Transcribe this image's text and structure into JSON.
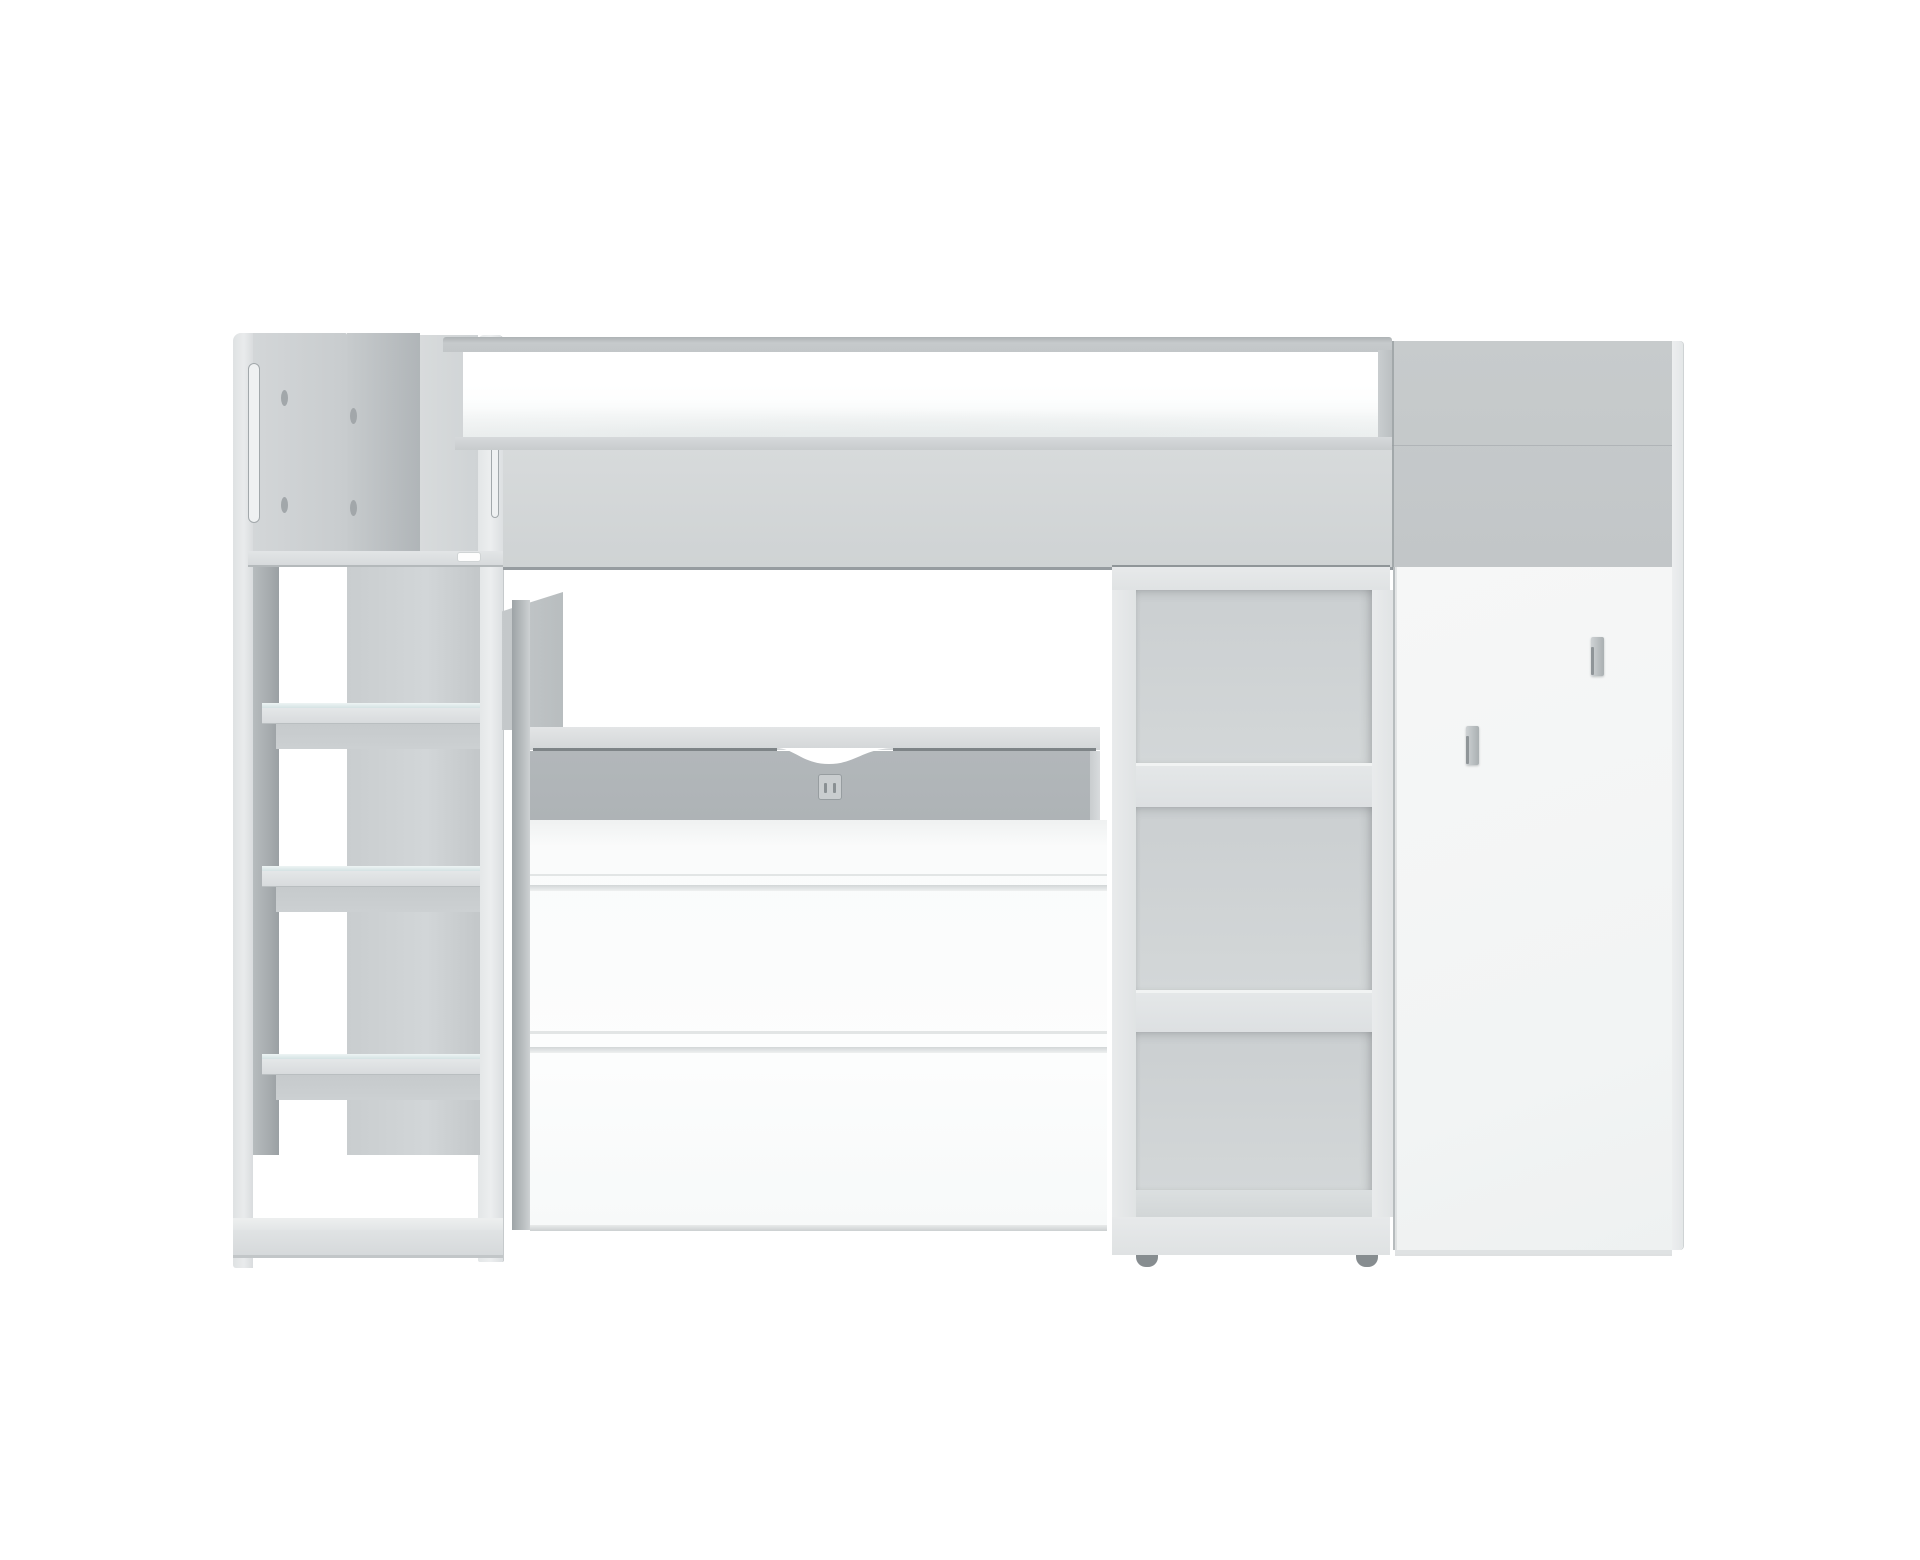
{
  "scene": {
    "type": "product-photo",
    "subject": "kids loft bed combination: high bed with guard rail, stair-ladder with shelves, desk with chest of drawers, open shelving unit and wardrobe",
    "background_color": "#ffffff",
    "text_content": "none"
  },
  "colors": {
    "bg": "#ffffff",
    "panel_light": "#d4d7d8",
    "panel_mid": "#c6cacc",
    "panel_dark": "#aeb3b6",
    "front_white": "#fafbfb",
    "rail_gray": "#b2b7ba",
    "interior_gray": "#ced2d3",
    "teal_step_edge": "#d5e2e3",
    "dark_line": "#8f9598",
    "handle_gray": "#aab0b2",
    "foot_dark": "#878d90"
  },
  "parts": {
    "head_panel": "gray headboard panel with vertical handle grooves and drill holes",
    "ladder": "stair ladder with top rail, three steps with glass-look edges and bottom shelf",
    "bed": "upper bed with gray guard rail frame, white mattress and gray front panel",
    "desk": "desk with gray back rail, cable notch cutout and outlet plate",
    "chest": "white chest of drawers with two horizontal grooves",
    "bookcase": "open shelving column with two thick shelves and casters",
    "wardrobe": "white wardrobe with gray upper panel and two vertical gray handles"
  }
}
